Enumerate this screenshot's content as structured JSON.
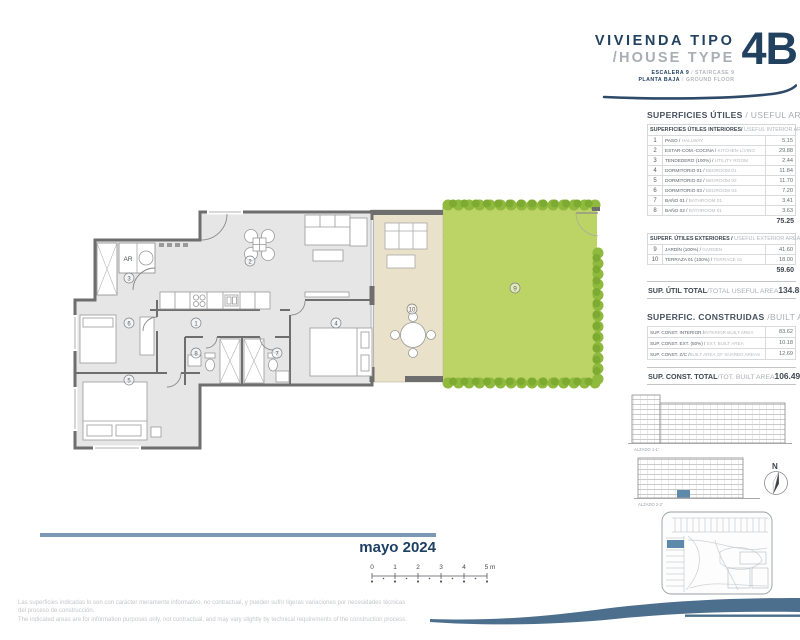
{
  "header": {
    "title_es": "VIVIENDA TIPO",
    "title_en": "/HOUSE TYPE",
    "unit_code": "4B",
    "sub1_es": "ESCALERA 9",
    "sub1_sep": " / ",
    "sub1_en": "STAIRCASE 9",
    "sub2_es": "PLANTA BAJA",
    "sub2_sep": " / ",
    "sub2_en": "GROUND FLOOR"
  },
  "areas": {
    "useful_title_es": "SUPERFICIES ÚTILES",
    "useful_title_en": " / USEFUL AREA",
    "interior": {
      "header_es": "SUPERFICIES ÚTILES INTERIORES/",
      "header_en": " USEFUL INTERIOR AREAS",
      "rows": [
        {
          "n": "1",
          "es": "PASO /",
          "en": " HALLWAY",
          "value": "5.15"
        },
        {
          "n": "2",
          "es": "ESTAR-COM.-COCINA /",
          "en": " KITCHEN-LIVING",
          "value": "29.88"
        },
        {
          "n": "3",
          "es": "TENDEDERO (100%) /",
          "en": " UTILITY ROOM",
          "value": "2.44"
        },
        {
          "n": "4",
          "es": "DORMITORIO 01 /",
          "en": " BEDROOM 01",
          "value": "11.84"
        },
        {
          "n": "5",
          "es": "DORMITORIO 02 /",
          "en": " BEDROOM 02",
          "value": "11.70"
        },
        {
          "n": "6",
          "es": "DORMITORIO 03 /",
          "en": " BEDROOM 03",
          "value": "7.20"
        },
        {
          "n": "7",
          "es": "BAÑO 01 /",
          "en": " BATHROOM 01",
          "value": "3.41"
        },
        {
          "n": "8",
          "es": "BAÑO 02 /",
          "en": " BATHROOM 01",
          "value": "3.63"
        }
      ],
      "subtotal": "75.25"
    },
    "exterior": {
      "header_es": "SUPERF. ÚTILES EXTERIORES /",
      "header_en": " USEFUL EXTERIOR AREAS",
      "rows": [
        {
          "n": "9",
          "es": "JARDÍN (100%) /",
          "en": " GARDEN",
          "value": "41.60"
        },
        {
          "n": "10",
          "es": "TERRAZA 01 (100%) /",
          "en": " TERRACE 01",
          "value": "18.00"
        }
      ],
      "subtotal": "59.60"
    },
    "useful_total": {
      "label_es": "SUP. ÚTIL TOTAL",
      "label_en": "/TOTAL USEFUL AREA",
      "value": "134.85"
    },
    "built_title_es": "SUPERFIC. CONSTRUIDAS",
    "built_title_en": " /BUILT AREAS",
    "built": {
      "rows": [
        {
          "es": "SUP. CONST. INTERIOR /",
          "en": "INTERIOR BUILT AREA",
          "value": "83.62"
        },
        {
          "es": "SUP. CONST. EXT. (50%) /",
          "en": " EXT. BUILT AREA",
          "value": "10.18"
        },
        {
          "es": "SUP. CONST. Z/C /",
          "en": "BUILT AREA OF SHARED AREAS",
          "value": "12.69"
        }
      ],
      "total": {
        "label_es": "SUP. CONST. TOTAL",
        "label_en": "/TOT. BUILT AREA",
        "value": "106.49"
      }
    }
  },
  "plan": {
    "ar_label": "AR",
    "rooms": [
      {
        "n": "1"
      },
      {
        "n": "2"
      },
      {
        "n": "3"
      },
      {
        "n": "4"
      },
      {
        "n": "5"
      },
      {
        "n": "6"
      },
      {
        "n": "7"
      },
      {
        "n": "8"
      },
      {
        "n": "9"
      },
      {
        "n": "10"
      }
    ]
  },
  "drawings": {
    "elevation1_label": "ALZADO 1-1'",
    "elevation2_label": "ALZADO 2-2'",
    "north_label": "N"
  },
  "date_label": "mayo 2024",
  "scalebar": {
    "ticks": [
      "0",
      "1",
      "2",
      "3",
      "4"
    ],
    "last_tick": "5 m"
  },
  "disclaimer": {
    "line1": "Las superficies indicadas lo son con carácter meramente informativo, no contractual, y pueden sufrir ligeras variaciones por necesidades técnicas",
    "line2": "del proceso de construcción.",
    "line3": "The indicated areas are for information purposes only, not contractual, and may vary slightly by technical requirements of the construction process."
  },
  "colors": {
    "navy": "#21415f",
    "steel_bar": "#7b98b4",
    "swoosh": "#4d6f8e",
    "garden_green": "#bcd365",
    "hedge_green": "#8fba3e",
    "terrace_beige": "#e9e1c9",
    "wall_gray": "#6e6e6e",
    "highlight_unit_blue": "#5d89ab"
  }
}
